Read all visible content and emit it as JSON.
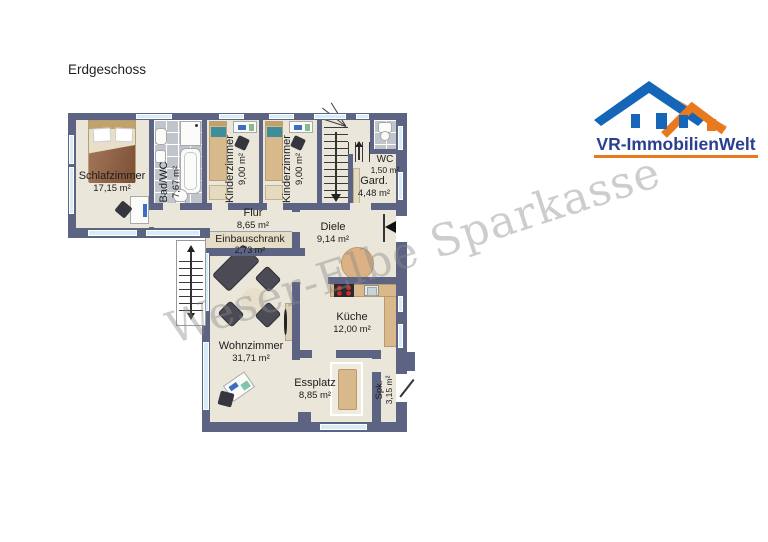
{
  "title": "Erdgeschoss",
  "watermark": "Weser-Elbe Sparkasse",
  "logo": {
    "brand": "VR-ImmobilienWelt"
  },
  "plan": {
    "floor_name": "Erdgeschoss",
    "rooms": [
      {
        "name": "Schlafzimmer",
        "area": "17,15 m²"
      },
      {
        "name": "Bad/WC",
        "area": "7,67 m²"
      },
      {
        "name": "Kinderzimmer",
        "area": "9,00 m²"
      },
      {
        "name": "Kinderzimmer",
        "area": "9,00 m²"
      },
      {
        "name": "WC",
        "area": "1,50 m²"
      },
      {
        "name": "Gard.",
        "area": "4,48 m²"
      },
      {
        "name": "Flur",
        "area": "8,65 m²"
      },
      {
        "name": "Einbauschrank",
        "area": "2,73 m²"
      },
      {
        "name": "Diele",
        "area": "9,14 m²"
      },
      {
        "name": "Küche",
        "area": "12,00 m²"
      },
      {
        "name": "Wohnzimmer",
        "area": "31,71 m²"
      },
      {
        "name": "Essplatz",
        "area": "8,85 m²"
      },
      {
        "name": "Spk.",
        "area": "3,15 m²"
      }
    ],
    "icons": {
      "entrance": "left-arrow",
      "stairs_main": "down-arrow",
      "stairs_exterior": "up-down-arrow"
    }
  },
  "colors": {
    "wall": "#5c6383",
    "floor": "#ebe6da",
    "tile": "#c0c5cc",
    "window_glass": "#d6ecf7",
    "logo_blue": "#1565b8",
    "logo_orange": "#e8791d",
    "logo_text": "#2a3f8f",
    "watermark": "#8a8a8a"
  }
}
